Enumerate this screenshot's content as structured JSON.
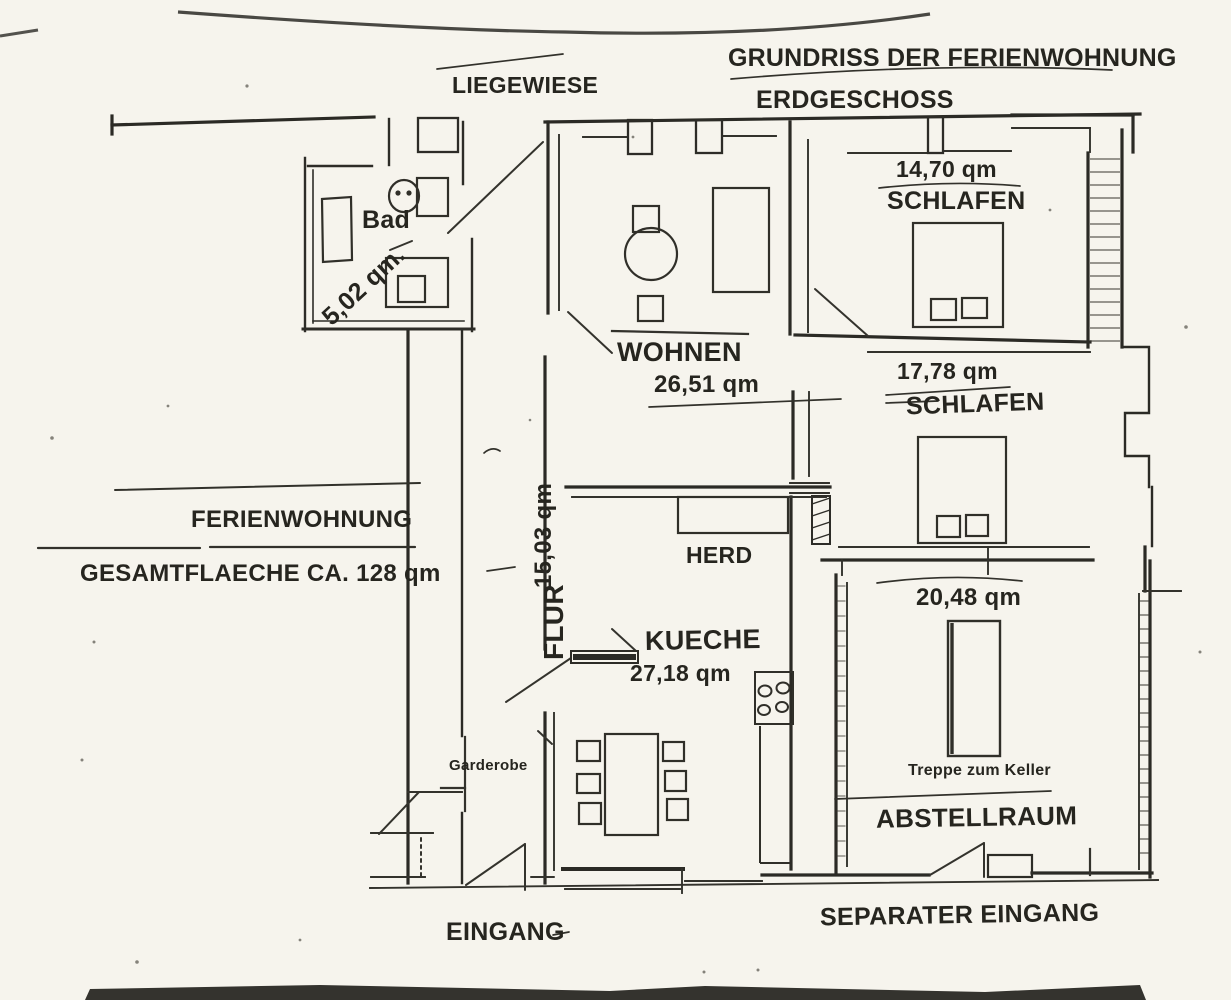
{
  "header": {
    "title": "GRUNDRISS DER FERIENWOHNUNG",
    "subtitle": "ERDGESCHOSS"
  },
  "site": {
    "lawn_label": "LIEGEWIESE"
  },
  "apartment": {
    "name": "FERIENWOHNUNG",
    "total_area": "GESAMTFLAECHE CA. 128 qm"
  },
  "rooms": {
    "bad": {
      "label": "Bad",
      "area": "5,02 qm."
    },
    "wohnen": {
      "label": "WOHNEN",
      "area": "26,51 qm"
    },
    "schlafen1": {
      "label": "SCHLAFEN",
      "area": "14,70 qm"
    },
    "schlafen2": {
      "label": "SCHLAFEN",
      "area": "17,78 qm"
    },
    "flur": {
      "label": "FLUR",
      "area": "15,03 qm"
    },
    "kueche": {
      "label": "KUECHE",
      "area": "27,18 qm"
    },
    "abstellraum": {
      "label": "ABSTELLRAUM",
      "area": "20,48 qm"
    },
    "herd_label": "HERD",
    "garderobe_label": "Garderobe",
    "treppe_label": "Treppe zum Keller"
  },
  "entrances": {
    "main": "EINGANG",
    "separate": "SEPARATER EINGANG"
  },
  "colors": {
    "ink": "#26251f",
    "paper": "#f6f4ed"
  }
}
